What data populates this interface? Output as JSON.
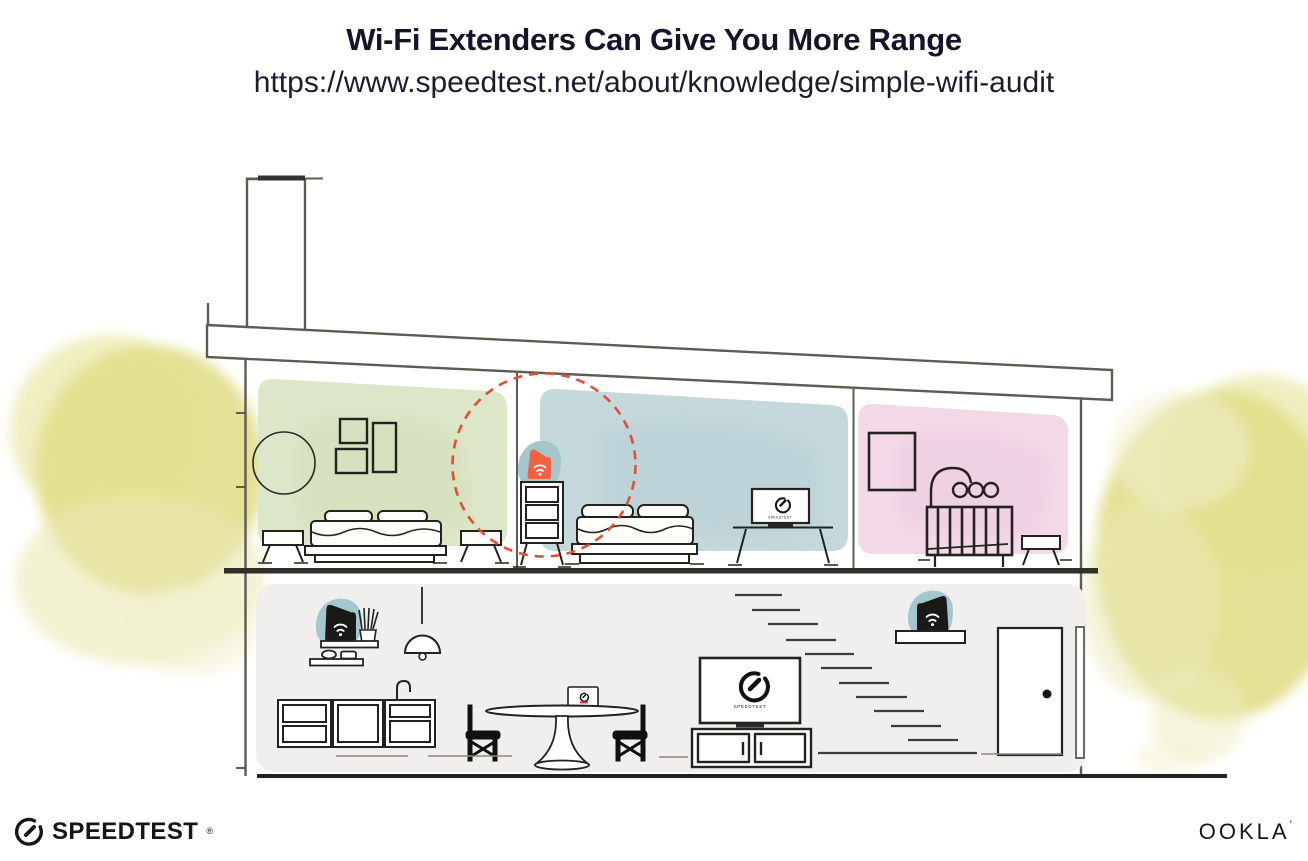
{
  "header": {
    "title": "Wi-Fi Extenders Can Give You More Range",
    "url": "https://www.speedtest.net/about/knowledge/simple-wifi-audit"
  },
  "house": {
    "tv_label": "SPEEDTEST",
    "rooms": [
      {
        "name": "bedroom-left",
        "wall_color": "#dce6c8"
      },
      {
        "name": "bedroom-middle",
        "wall_color": "#c5d9dc"
      },
      {
        "name": "nursery",
        "wall_color": "#f3d9e8"
      },
      {
        "name": "living-area",
        "wall_color": "#f0efed"
      }
    ],
    "devices": [
      {
        "name": "wifi-extender-bedroom",
        "color": "#ee6344",
        "backdrop_color": "#a4c7ce"
      },
      {
        "name": "wifi-router-living-room",
        "color": "#191917",
        "backdrop_color": "#a4c7ce"
      },
      {
        "name": "wifi-extender-entry",
        "color": "#191917",
        "backdrop_color": "#a4c7ce"
      }
    ],
    "range_circle_color": "#e05038",
    "structure_line_color": "#5e5b54",
    "foliage_color": "#dcd978"
  },
  "footer": {
    "speedtest": "SPEEDTEST",
    "speedtest_mark": "®",
    "ookla": "OOKLA",
    "ookla_mark": "’"
  }
}
